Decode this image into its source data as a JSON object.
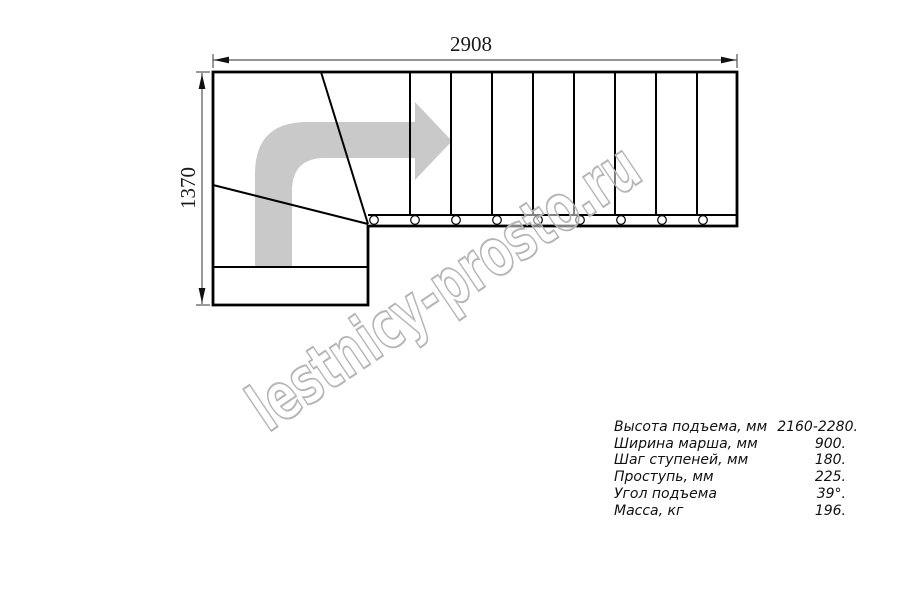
{
  "colors": {
    "line": "#000000",
    "arrow": "#c9c9c9",
    "watermark_outline": "#b5b5b5"
  },
  "drawing": {
    "width_dimension": "2908",
    "height_dimension": "1370",
    "watermark": "lestnicy-prosto.ru",
    "direction_arrow_icon": "curved-right-arrow"
  },
  "specs": {
    "rows": [
      {
        "label": "Высота подъема, мм",
        "value": "2160-2280."
      },
      {
        "label": "Ширина марша, мм",
        "value": "900."
      },
      {
        "label": "Шаг ступеней, мм",
        "value": "180."
      },
      {
        "label": "Проступь, мм",
        "value": "225."
      },
      {
        "label": "Угол подъема",
        "value": "39°."
      },
      {
        "label": "Масса, кг",
        "value": "196."
      }
    ]
  }
}
